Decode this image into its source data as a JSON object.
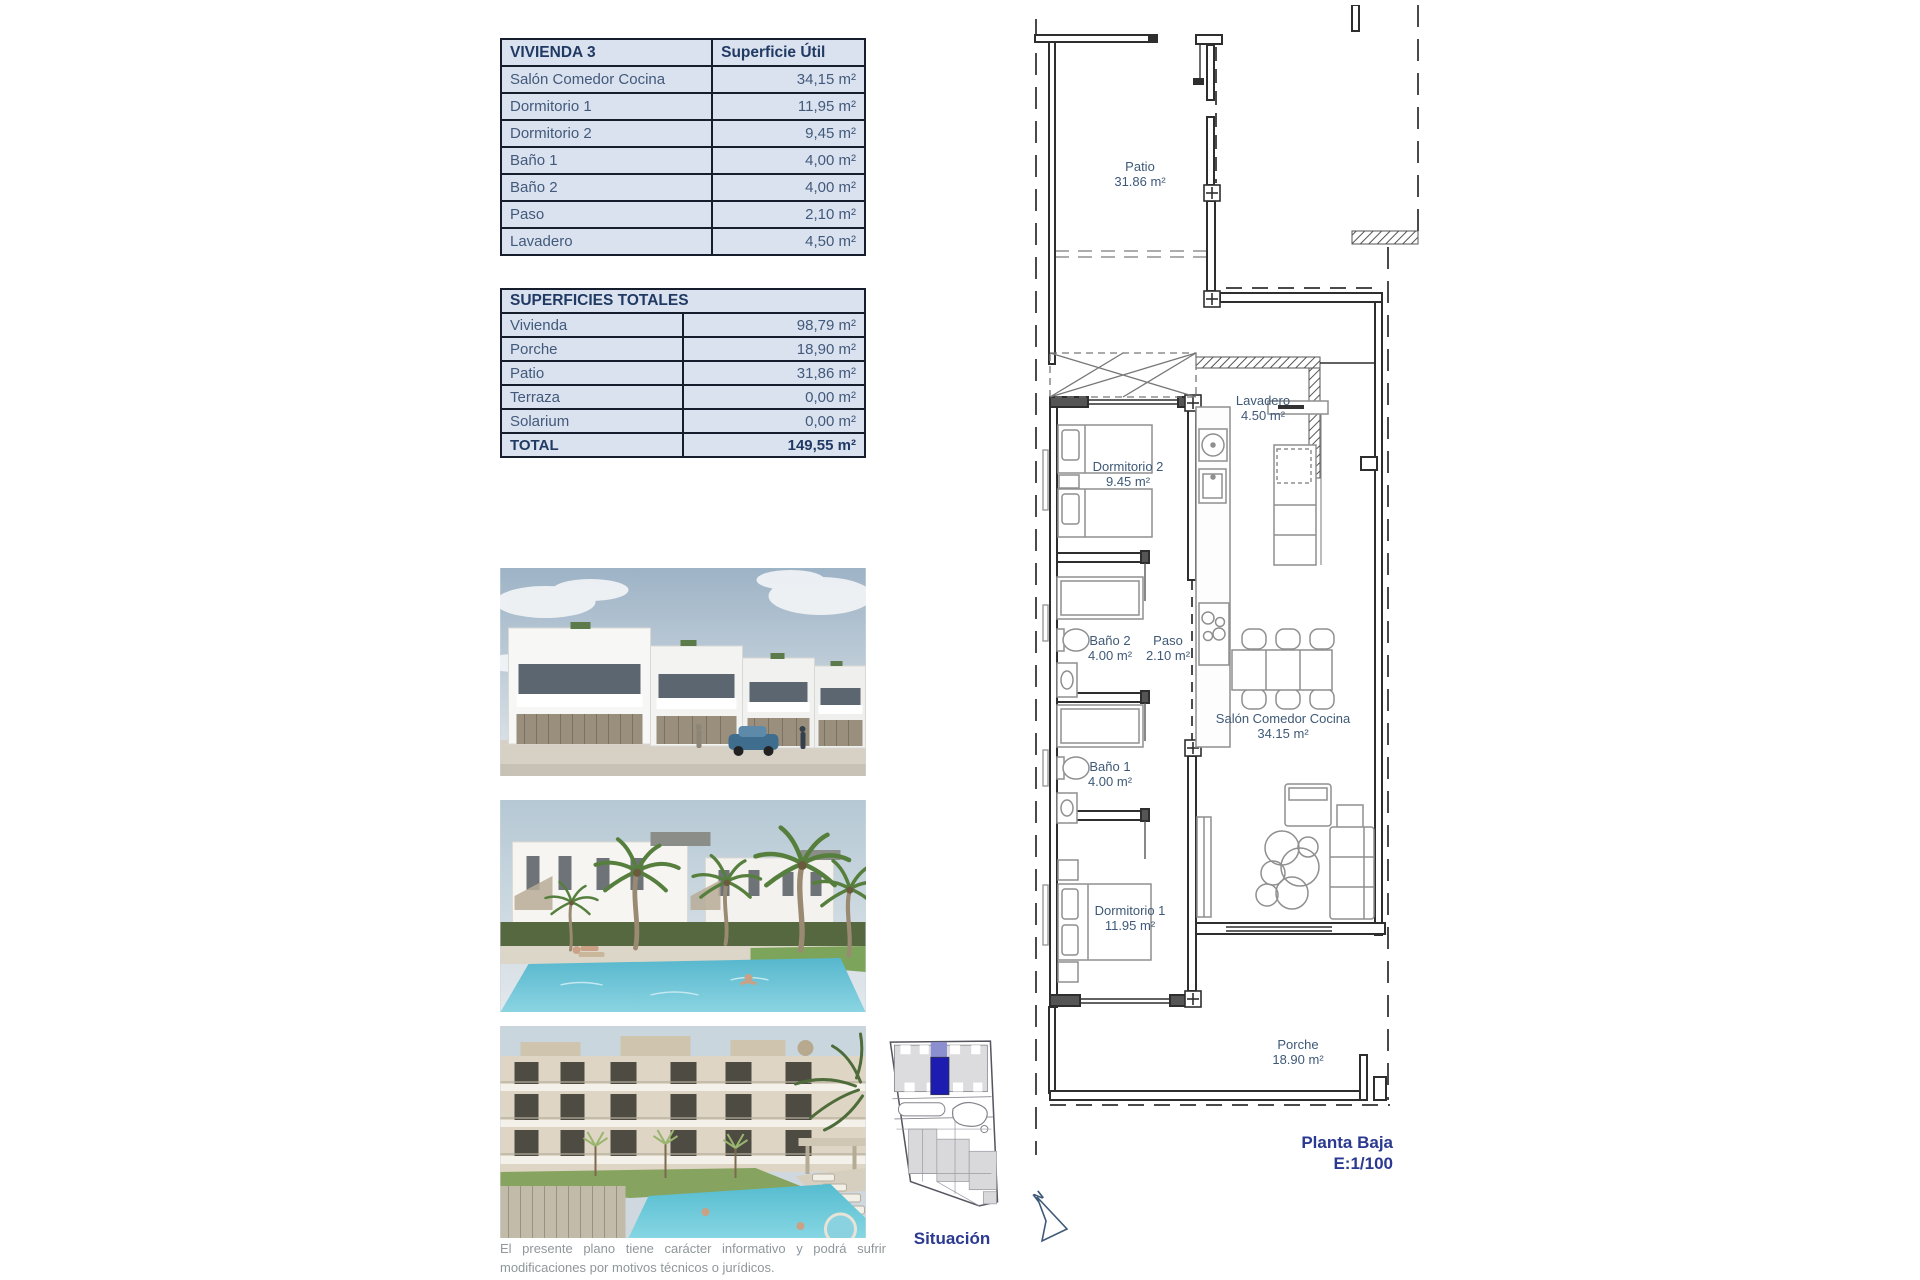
{
  "vivienda_table": {
    "title": "VIVIENDA 3",
    "header_value": "Superficie Útil",
    "rows": [
      {
        "label": "Salón Comedor Cocina",
        "value": "34,15 m²"
      },
      {
        "label": "Dormitorio 1",
        "value": "11,95 m²"
      },
      {
        "label": "Dormitorio 2",
        "value": "9,45 m²"
      },
      {
        "label": "Baño 1",
        "value": "4,00 m²"
      },
      {
        "label": "Baño 2",
        "value": "4,00 m²"
      },
      {
        "label": "Paso",
        "value": "2,10 m²"
      },
      {
        "label": "Lavadero",
        "value": "4,50 m²"
      }
    ]
  },
  "totales_table": {
    "title": "SUPERFICIES TOTALES",
    "rows": [
      {
        "label": "Vivienda",
        "value": "98,79 m²"
      },
      {
        "label": "Porche",
        "value": "18,90 m²"
      },
      {
        "label": "Patio",
        "value": "31,86 m²"
      },
      {
        "label": "Terraza",
        "value": "0,00 m²"
      },
      {
        "label": "Solarium",
        "value": "0,00 m²"
      }
    ],
    "total": {
      "label": "TOTAL",
      "value": "149,55 m²"
    }
  },
  "floorplan": {
    "rooms": {
      "patio": {
        "name": "Patio",
        "area": "31.86 m²"
      },
      "lavadero": {
        "name": "Lavadero",
        "area": "4.50 m²"
      },
      "dormitorio2": {
        "name": "Dormitorio 2",
        "area": "9.45 m²"
      },
      "bano2": {
        "name": "Baño 2",
        "area": "4.00 m²"
      },
      "paso": {
        "name": "Paso",
        "area": "2.10 m²"
      },
      "salon": {
        "name": "Salón Comedor Cocina",
        "area": "34.15 m²"
      },
      "bano1": {
        "name": "Baño 1",
        "area": "4.00 m²"
      },
      "dormitorio1": {
        "name": "Dormitorio 1",
        "area": "11.95 m²"
      },
      "porche": {
        "name": "Porche",
        "area": "18.90 m²"
      }
    },
    "caption_line1": "Planta Baja",
    "caption_line2": "E:1/100",
    "north_label": "N"
  },
  "situacion": {
    "label": "Situación",
    "highlight_color": "#1c1cb0"
  },
  "disclaimer": "El presente plano tiene carácter informativo y podrá sufrir modificaciones por motivos técnicos o jurídicos.",
  "colors": {
    "table_bg": "#dbe2ef",
    "table_border": "#161e2e",
    "table_text": "#41597a",
    "header_text": "#203a63",
    "plan_label": "#3e5977",
    "caption_navy": "#2b3990"
  }
}
